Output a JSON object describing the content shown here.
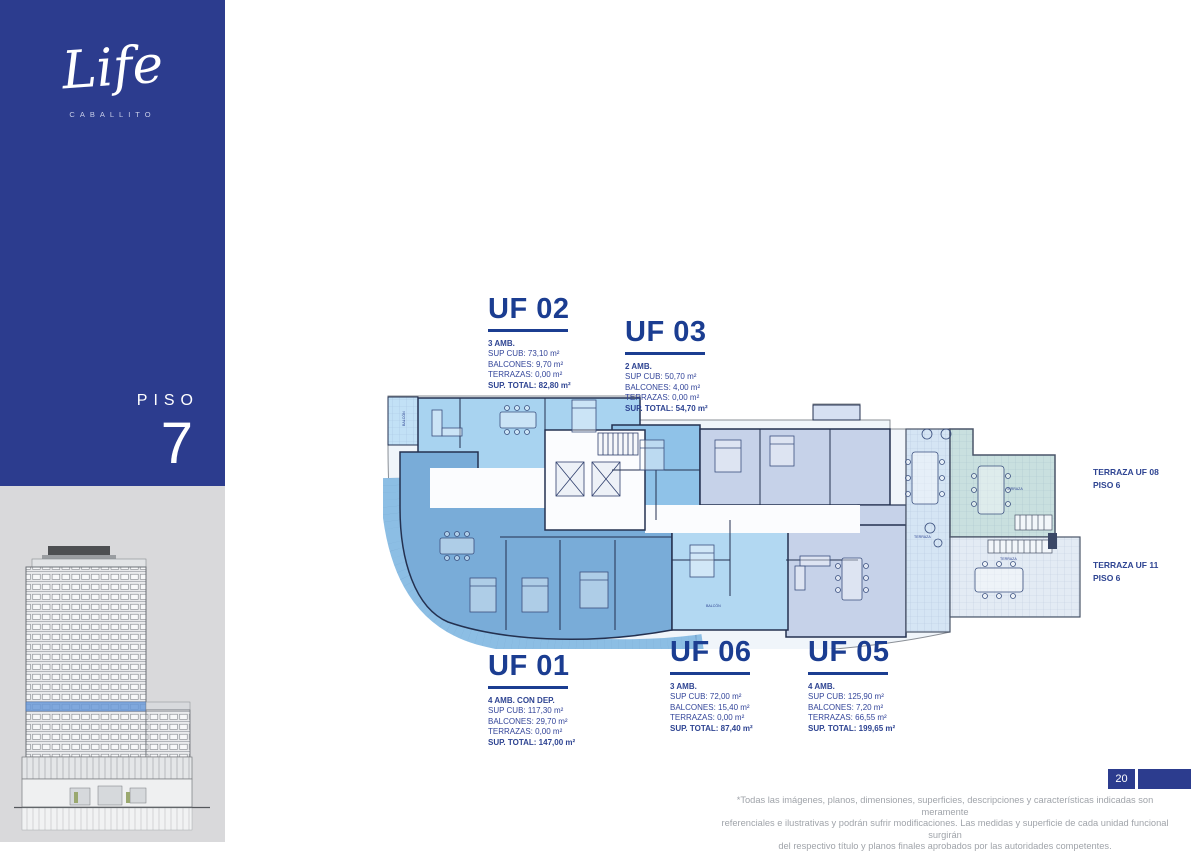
{
  "brand": {
    "logo_text": "Life",
    "logo_subtext": "CABALLITO"
  },
  "sidebar": {
    "floor_label": "PISO",
    "floor_number": "7"
  },
  "units": {
    "uf02": {
      "title": "UF 02",
      "amb": "3 AMB.",
      "sup_cub": "SUP CUB: 73,10 m²",
      "balcones": "BALCONES: 9,70 m²",
      "terrazas": "TERRAZAS: 0,00 m²",
      "total": "SUP. TOTAL: 82,80 m²"
    },
    "uf03": {
      "title": "UF 03",
      "amb": "2 AMB.",
      "sup_cub": "SUP CUB: 50,70 m²",
      "balcones": "BALCONES: 4,00 m²",
      "terrazas": "TERRAZAS: 0,00 m²",
      "total": "SUP. TOTAL: 54,70 m²"
    },
    "uf01": {
      "title": "UF 01",
      "amb": "4 AMB. CON DEP.",
      "sup_cub": "SUP CUB: 117,30 m²",
      "balcones": "BALCONES: 29,70 m²",
      "terrazas": "TERRAZAS: 0,00 m²",
      "total": "SUP. TOTAL: 147,00 m²"
    },
    "uf06": {
      "title": "UF 06",
      "amb": "3 AMB.",
      "sup_cub": "SUP CUB: 72,00 m²",
      "balcones": "BALCONES: 15,40 m²",
      "terrazas": "TERRAZAS: 0,00 m²",
      "total": "SUP. TOTAL: 87,40 m²"
    },
    "uf05": {
      "title": "UF 05",
      "amb": "4 AMB.",
      "sup_cub": "SUP CUB: 125,90 m²",
      "balcones": "BALCONES: 7,20 m²",
      "terrazas": "TERRAZAS: 66,55 m²",
      "total": "SUP. TOTAL: 199,65 m²"
    }
  },
  "terrace_labels": [
    {
      "title": "TERRAZA UF 08",
      "floor": "PISO 6"
    },
    {
      "title": "TERRAZA UF 11",
      "floor": "PISO 6"
    }
  ],
  "plan": {
    "annotations": {
      "balcon": "BALCÓN",
      "terraza": "TERRAZA"
    }
  },
  "footer": {
    "page_number": "20",
    "disclaimer_line1": "*Todas las imágenes, planos, dimensiones, superficies, descripciones y características indicadas son meramente",
    "disclaimer_line2": "referenciales e ilustrativas y podrán sufrir modificaciones. Las medidas y superficie de cada unidad funcional surgirán",
    "disclaimer_line3": "del respectivo título y planos finales aprobados por las autoridades competentes."
  },
  "colors": {
    "brand_navy": "#2C3C8E",
    "title_navy": "#1B3D91",
    "text_navy": "#2E4492",
    "footer_gray": "#A0A4AA",
    "uf01_fill": "#79ACD8",
    "uf02_fill": "#A8D3F0",
    "uf03_fill": "#8FC2E8",
    "uf05_fill": "#C6D2E9",
    "uf06_fill": "#B2D8F2",
    "terrace_teal": "#C9E0DF",
    "terrace_light": "#D5E5F4",
    "terrace_pale": "#E3EBF4",
    "floor_highlight": "#6C9BD9"
  }
}
